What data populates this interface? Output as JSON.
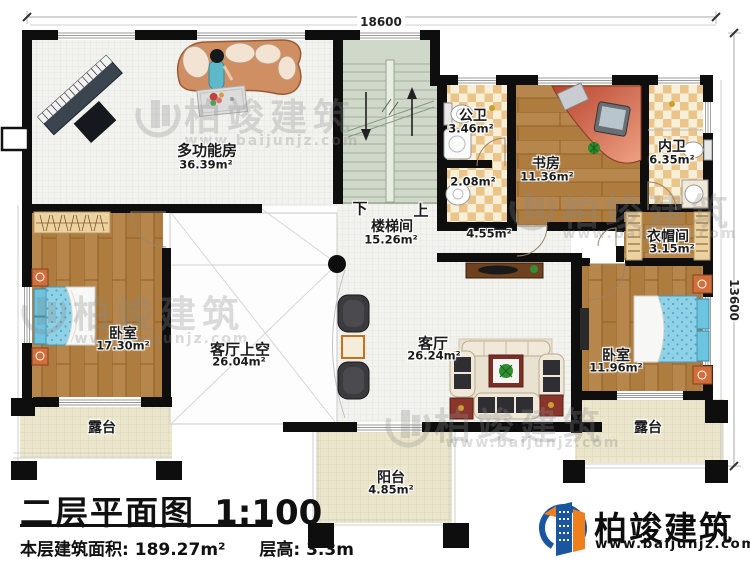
{
  "title": {
    "main": "二层平面图",
    "scale": "1:100"
  },
  "stats": {
    "area_label": "本层建筑面积:",
    "area_value": "189.27m²",
    "height_label": "层高:",
    "height_value": "3.3m"
  },
  "dimensions": {
    "width": "18600",
    "height": "13600"
  },
  "brand": {
    "name": "柏竣建筑",
    "url": "www.baijunjz.com"
  },
  "stairs": {
    "down": "下",
    "up": "上"
  },
  "rooms": {
    "multifunction": {
      "name": "多功能房",
      "area": "36.39m²"
    },
    "public_bath": {
      "name": "公卫",
      "area": "3.46m²"
    },
    "study": {
      "name": "书房",
      "area": "11.36m²"
    },
    "ensuite_bath": {
      "name": "内卫",
      "area": "6.35m²"
    },
    "stairwell": {
      "name": "楼梯间",
      "area": "15.26m²"
    },
    "cloakroom": {
      "name": "衣帽间",
      "area": "3.15m²"
    },
    "bedroom_left": {
      "name": "卧室",
      "area": "17.30m²"
    },
    "living_void": {
      "name": "客厅上空",
      "area": "26.04m²"
    },
    "living_room": {
      "name": "客厅",
      "area": "26.24m²"
    },
    "bedroom_right": {
      "name": "卧室",
      "area": "11.96m²"
    },
    "terrace_left": {
      "name": "露台"
    },
    "terrace_right": {
      "name": "露台"
    },
    "balcony": {
      "name": "阳台",
      "area": "4.85m²"
    }
  },
  "annotations": {
    "washbasin_area": "2.08m²",
    "hallway_area": "4.55m²"
  },
  "colors": {
    "brand_blue": "#1a56a0",
    "brand_orange": "#ef7f1b",
    "wall": "#0e0e0e"
  }
}
